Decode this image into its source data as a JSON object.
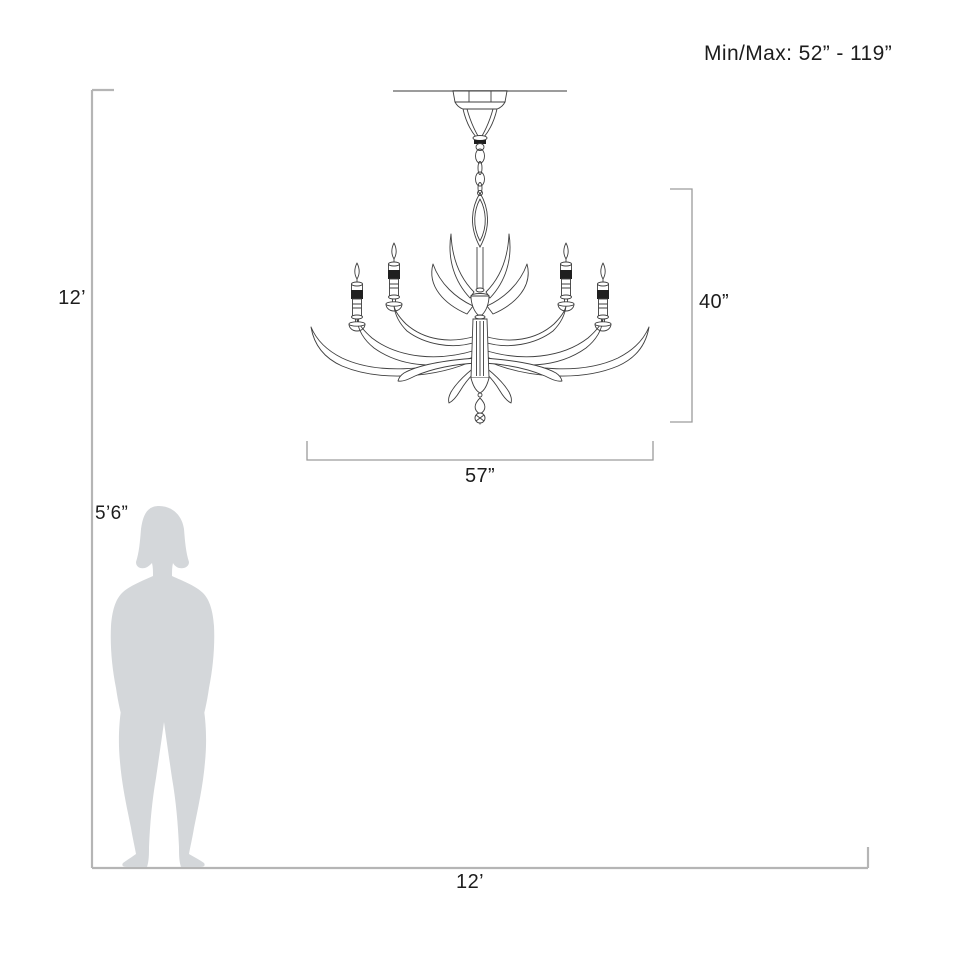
{
  "annotations": {
    "min_max_label": "Min/Max: 52” - 119”",
    "ceiling_height_label": "12’",
    "fixture_height_label": "40”",
    "fixture_width_label": "57”",
    "person_height_label": "5’6”",
    "floor_width_label": "12’"
  },
  "figure": {
    "subject": "chandelier-line-drawing",
    "visible_candles": 4,
    "scale_reference": "standing-person-silhouette"
  },
  "colors": {
    "dimension_line": "#b5b5b5",
    "bracket_line": "#9c9c9c",
    "drawing_line": "#3f3f3f",
    "drawing_dark": "#1f1f1f",
    "silhouette": "#d4d7da",
    "text": "#1d1d1d",
    "background": "#ffffff"
  }
}
